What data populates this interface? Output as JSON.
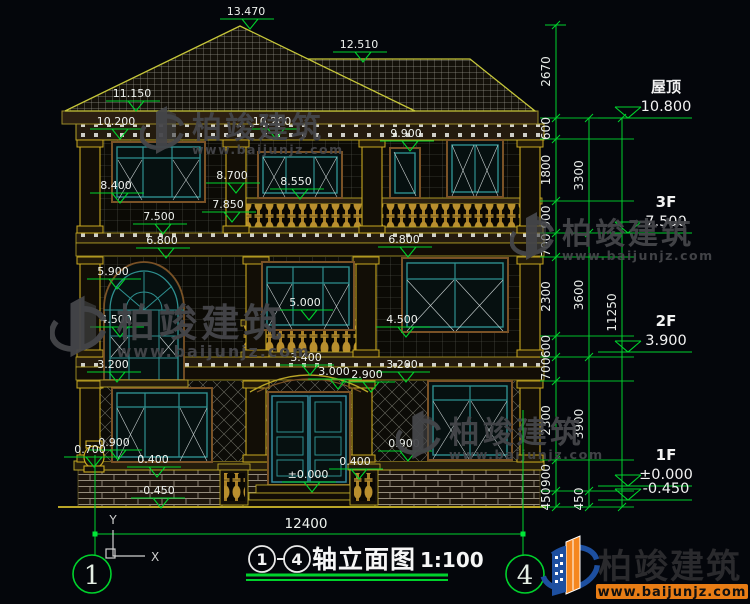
{
  "watermark": {
    "name": "柏竣建筑",
    "url": "www.baijunjz.com"
  },
  "brand": {
    "name": "柏竣建筑",
    "url": "www.baijunjz.com"
  },
  "titlebar": {
    "axis_start": "1",
    "axis_end": "4",
    "name": "轴立面图",
    "scale": "1:100"
  },
  "annotations": {
    "overall_width": "12400",
    "axis_left": "1",
    "axis_right": "4",
    "ucs_x": "X",
    "ucs_y": "Y"
  },
  "colors": {
    "dim_green": "#00d22c",
    "gold": "#b9a427",
    "teal": "#2e8f8f",
    "brand_blue": "#1d4fa0",
    "brand_orange": "#f5871f"
  },
  "level_markers": [
    {
      "label": "屋顶",
      "elevation": "10.800",
      "y": 118
    },
    {
      "label": "3F",
      "elevation": "7.500",
      "y": 233
    },
    {
      "label": "2F",
      "elevation": "3.900",
      "y": 352
    },
    {
      "label": "1F",
      "elevation": "±0.000",
      "y": 486
    },
    {
      "label": "",
      "elevation": "-0.450",
      "y": 500
    }
  ],
  "elevation_markers": [
    {
      "label": "13.470",
      "x": 250,
      "y": 26
    },
    {
      "label": "12.510",
      "x": 363,
      "y": 59
    },
    {
      "label": "11.150",
      "x": 136,
      "y": 108
    },
    {
      "label": "10.200",
      "x": 120,
      "y": 136
    },
    {
      "label": "10.200",
      "x": 276,
      "y": 136
    },
    {
      "label": "9.900",
      "x": 410,
      "y": 148
    },
    {
      "label": "8.700",
      "x": 236,
      "y": 190
    },
    {
      "label": "8.550",
      "x": 300,
      "y": 196
    },
    {
      "label": "8.400",
      "x": 120,
      "y": 200
    },
    {
      "label": "7.850",
      "x": 232,
      "y": 219
    },
    {
      "label": "7.500",
      "x": 163,
      "y": 231
    },
    {
      "label": "6.800",
      "x": 166,
      "y": 255
    },
    {
      "label": "6.800",
      "x": 408,
      "y": 254
    },
    {
      "label": "5.900",
      "x": 117,
      "y": 286
    },
    {
      "label": "5.000",
      "x": 309,
      "y": 317
    },
    {
      "label": "4.500",
      "x": 120,
      "y": 334
    },
    {
      "label": "4.500",
      "x": 406,
      "y": 334
    },
    {
      "label": "3.400",
      "x": 310,
      "y": 372
    },
    {
      "label": "3.200",
      "x": 117,
      "y": 379
    },
    {
      "label": "3.200",
      "x": 406,
      "y": 379
    },
    {
      "label": "3.000",
      "x": 338,
      "y": 386
    },
    {
      "label": "2.900",
      "x": 371,
      "y": 389
    },
    {
      "label": "0.900",
      "x": 118,
      "y": 457
    },
    {
      "label": "0.900",
      "x": 408,
      "y": 458
    },
    {
      "label": "0.700",
      "x": 94,
      "y": 464
    },
    {
      "label": "0.400",
      "x": 157,
      "y": 474
    },
    {
      "label": "0.400",
      "x": 359,
      "y": 476
    },
    {
      "label": "±0.000",
      "x": 312,
      "y": 489
    },
    {
      "label": "-0.450",
      "x": 161,
      "y": 505
    }
  ],
  "dim_chains": [
    {
      "x": 556,
      "segments": [
        {
          "v": "2670",
          "y1": 25,
          "y2": 118
        },
        {
          "v": "600",
          "y1": 118,
          "y2": 139
        },
        {
          "v": "1800",
          "y1": 139,
          "y2": 201
        },
        {
          "v": "900",
          "y1": 201,
          "y2": 233
        },
        {
          "v": "700",
          "y1": 233,
          "y2": 257
        },
        {
          "v": "2300",
          "y1": 257,
          "y2": 336
        },
        {
          "v": "600",
          "y1": 336,
          "y2": 357
        },
        {
          "v": "700",
          "y1": 357,
          "y2": 381
        },
        {
          "v": "2300",
          "y1": 381,
          "y2": 460
        },
        {
          "v": "900",
          "y1": 460,
          "y2": 491
        },
        {
          "v": "450",
          "y1": 491,
          "y2": 507
        }
      ]
    },
    {
      "x": 589,
      "segments": [
        {
          "v": "3300",
          "y1": 118,
          "y2": 233
        },
        {
          "v": "3600",
          "y1": 233,
          "y2": 357
        },
        {
          "v": "3900",
          "y1": 357,
          "y2": 491
        },
        {
          "v": "450",
          "y1": 491,
          "y2": 507
        }
      ]
    },
    {
      "x": 622,
      "segments": [
        {
          "v": "11250",
          "y1": 118,
          "y2": 507
        }
      ]
    }
  ],
  "watermark_positions": [
    {
      "x": 140,
      "y": 100,
      "s": 1.0
    },
    {
      "x": 50,
      "y": 288,
      "s": 1.28
    },
    {
      "x": 510,
      "y": 206,
      "s": 1.0
    },
    {
      "x": 396,
      "y": 404,
      "s": 1.02
    }
  ]
}
